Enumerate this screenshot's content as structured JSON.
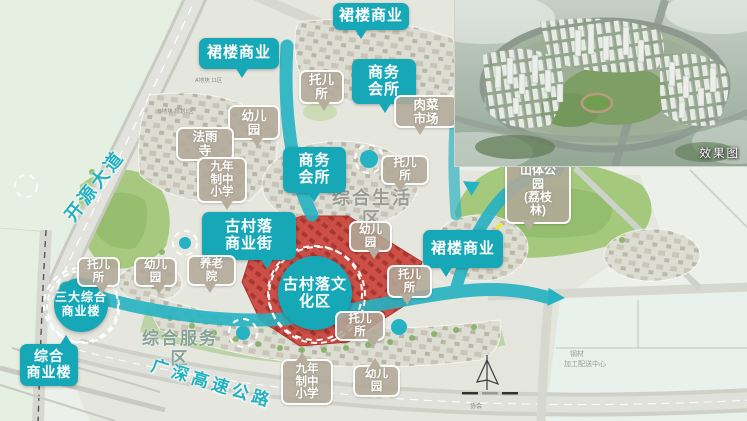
{
  "colors": {
    "accent_teal": "#17A8B8",
    "callout_tan": "#B2A998",
    "red_zone": "#C8403C",
    "ribbon_cyan": "#25B2C2",
    "park_green": "#A4C97D"
  },
  "inset": {
    "caption": "效果图"
  },
  "road_labels": {
    "kaiyuan": "开源大道",
    "expressway": "广深高速公路"
  },
  "area_labels": {
    "living": "综合生活\n区",
    "service": "综合服务区"
  },
  "circle_labels": [
    {
      "text": "古村落文\n化区"
    },
    {
      "text": "三大综合\n商业楼"
    }
  ],
  "teal_callouts": [
    {
      "text": "裙楼商业"
    },
    {
      "text": "裙楼商业"
    },
    {
      "text": "商务\n会所"
    },
    {
      "text": "商务\n会所"
    },
    {
      "text": "古村落\n商业街"
    },
    {
      "text": "裙楼商业"
    },
    {
      "text": "综合\n商业楼"
    }
  ],
  "tan_callouts": [
    {
      "text": "托儿\n所"
    },
    {
      "text": "幼儿\n园"
    },
    {
      "text": "法雨\n寺"
    },
    {
      "text": "九年\n制中\n小学"
    },
    {
      "text": "肉菜\n市场"
    },
    {
      "text": "托儿\n所"
    },
    {
      "text": "幼儿\n园"
    },
    {
      "text": "养老\n院"
    },
    {
      "text": "托儿\n所"
    },
    {
      "text": "幼儿\n园"
    },
    {
      "text": "托儿\n所"
    },
    {
      "text": "托儿\n所"
    },
    {
      "text": "九年\n制中\n小学"
    },
    {
      "text": "幼儿\n园"
    },
    {
      "text": "山体公\n园\n(荔枝\n林)"
    }
  ],
  "small_texts": {
    "parcel_a": "A地块 11区",
    "parcel_b": "B地块 规划1区",
    "steel_line1": "钢材",
    "steel_line2": "加工配送中心",
    "assoc": "协会"
  }
}
